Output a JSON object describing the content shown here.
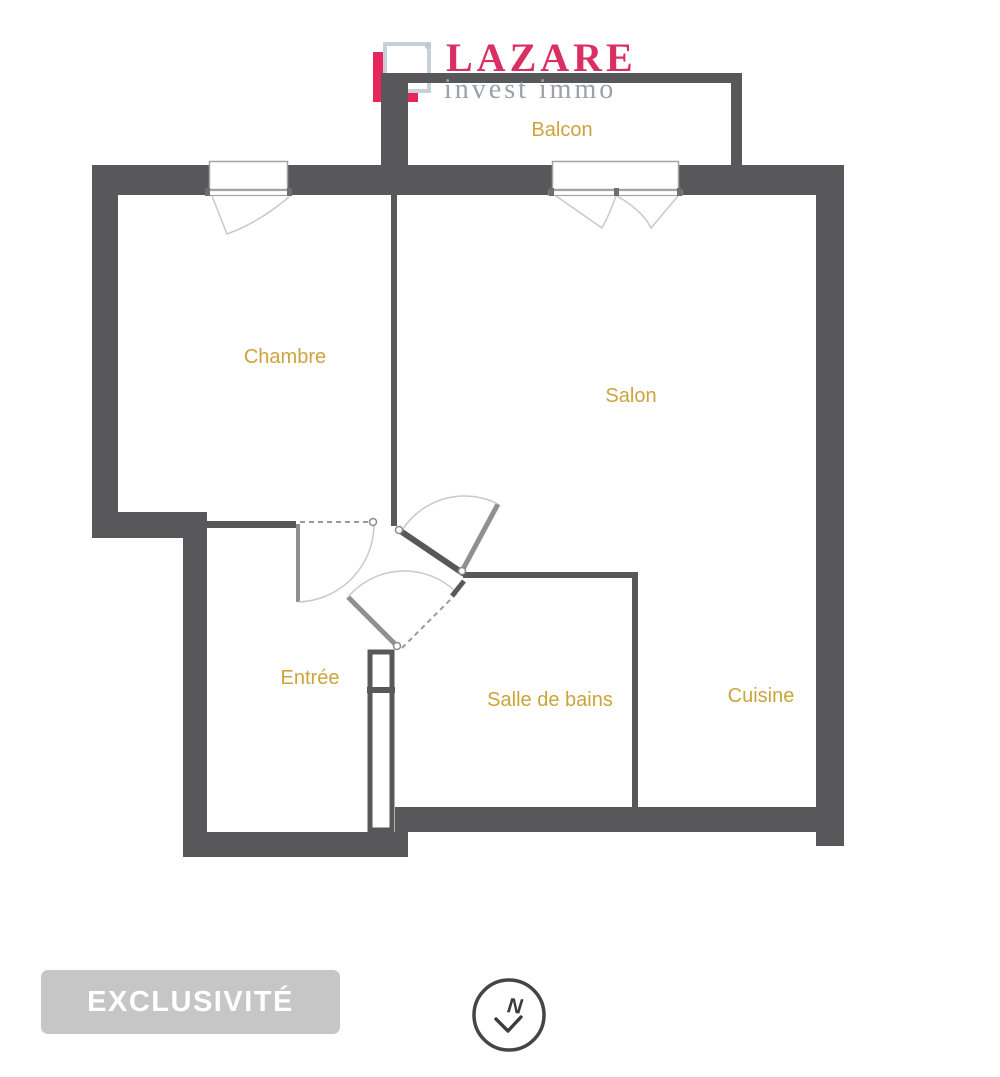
{
  "brand": {
    "name": "LAZARE",
    "tagline": "invest immo",
    "accent_color": "#da2f62",
    "tagline_color": "#9aa2a8",
    "mark": {
      "pink_square_color": "#e8265c",
      "gray_square_color": "#c8d1d8"
    }
  },
  "floorplan": {
    "wall_color": "#58585a",
    "label_color": "#cda43c",
    "rooms": [
      {
        "name": "Balcon"
      },
      {
        "name": "Chambre"
      },
      {
        "name": "Salon"
      },
      {
        "name": "Entrée"
      },
      {
        "name": "Salle de bains"
      },
      {
        "name": "Cuisine"
      }
    ]
  },
  "badge": {
    "label": "EXCLUSIVITÉ",
    "background": "#c6c6c6",
    "text_color": "#ffffff"
  },
  "compass": {
    "letter": "N"
  }
}
